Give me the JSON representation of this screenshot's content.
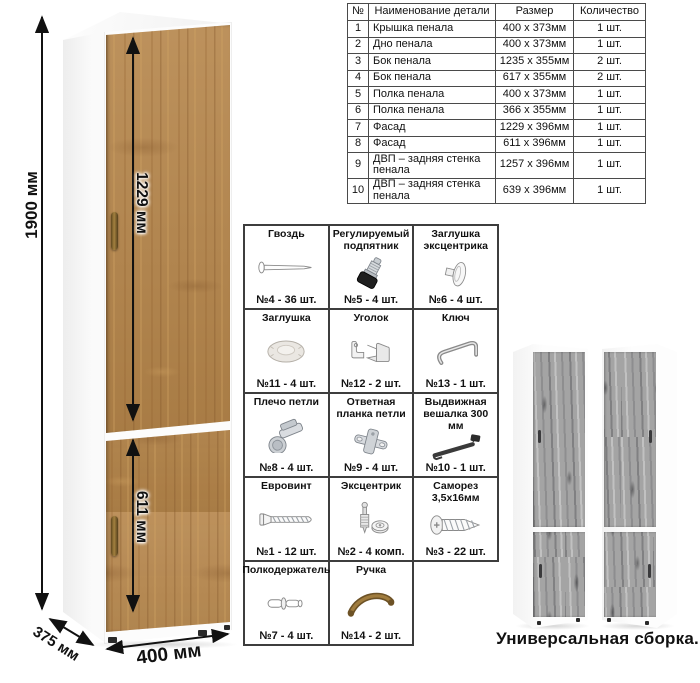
{
  "dimensions": {
    "height_label": "1900 мм",
    "upper_door_label": "1229 мм",
    "lower_door_label": "611 мм",
    "depth_label": "375 мм",
    "width_label": "400 мм"
  },
  "parts_table": {
    "headers": [
      "№",
      "Наименование детали",
      "Размер",
      "Количество"
    ],
    "rows": [
      [
        "1",
        "Крышка пенала",
        "400 x 373мм",
        "1 шт."
      ],
      [
        "2",
        "Дно пенала",
        "400 x 373мм",
        "1 шт."
      ],
      [
        "3",
        "Бок пенала",
        "1235 x 355мм",
        "2 шт."
      ],
      [
        "4",
        "Бок пенала",
        "617 x 355мм",
        "2 шт."
      ],
      [
        "5",
        "Полка пенала",
        "400 x 373мм",
        "1 шт."
      ],
      [
        "6",
        "Полка пенала",
        "366 x 355мм",
        "1 шт."
      ],
      [
        "7",
        "Фасад",
        "1229 x 396мм",
        "1 шт."
      ],
      [
        "8",
        "Фасад",
        "611 x 396мм",
        "1 шт."
      ],
      [
        "9",
        "ДВП – задняя стенка пенала",
        "1257 x 396мм",
        "1 шт."
      ],
      [
        "10",
        "ДВП – задняя стенка пенала",
        "639 x 396мм",
        "1 шт."
      ]
    ]
  },
  "hardware": {
    "items": [
      {
        "label": "Гвоздь",
        "count": "№4 - 36 шт.",
        "icon": "nail-icon"
      },
      {
        "label": "Регулируемый подпятник",
        "count": "№5 - 4 шт.",
        "icon": "adjustable-foot-icon"
      },
      {
        "label": "Заглушка эксцентрика",
        "count": "№6 - 4 шт.",
        "icon": "cam-cap-icon"
      },
      {
        "label": "Заглушка",
        "count": "№11 - 4 шт.",
        "icon": "plug-icon"
      },
      {
        "label": "Уголок",
        "count": "№12 - 2 шт.",
        "icon": "corner-bracket-icon"
      },
      {
        "label": "Ключ",
        "count": "№13 - 1 шт.",
        "icon": "hex-key-icon"
      },
      {
        "label": "Плечо петли",
        "count": "№8 - 4 шт.",
        "icon": "hinge-arm-icon"
      },
      {
        "label": "Ответная планка петли",
        "count": "№9 - 4 шт.",
        "icon": "hinge-plate-icon"
      },
      {
        "label": "Выдвижная вешалка 300 мм",
        "count": "№10 - 1 шт.",
        "icon": "pullout-hanger-icon"
      },
      {
        "label": "Евровинт",
        "count": "№1 - 12 шт.",
        "icon": "euro-screw-icon"
      },
      {
        "label": "Эксцентрик",
        "count": "№2 - 4 комп.",
        "icon": "cam-lock-icon"
      },
      {
        "label": "Саморез 3,5х16мм",
        "count": "№3 - 22 шт.",
        "icon": "self-tapping-screw-icon"
      },
      {
        "label": "Полкодержатель",
        "count": "№7 - 4 шт.",
        "icon": "shelf-pin-icon"
      },
      {
        "label": "Ручка",
        "count": "№14 - 2 шт.",
        "icon": "handle-icon"
      }
    ]
  },
  "variants": {
    "caption": "Универсальная сборка."
  },
  "colors": {
    "oak_wood": "#b5854a",
    "gray_wood": "#a4a4a4",
    "carcass_white": "#fcfcfc",
    "handle_bronze": "#8a6a35",
    "line_black": "#111111",
    "table_border": "#4a4a4a"
  }
}
